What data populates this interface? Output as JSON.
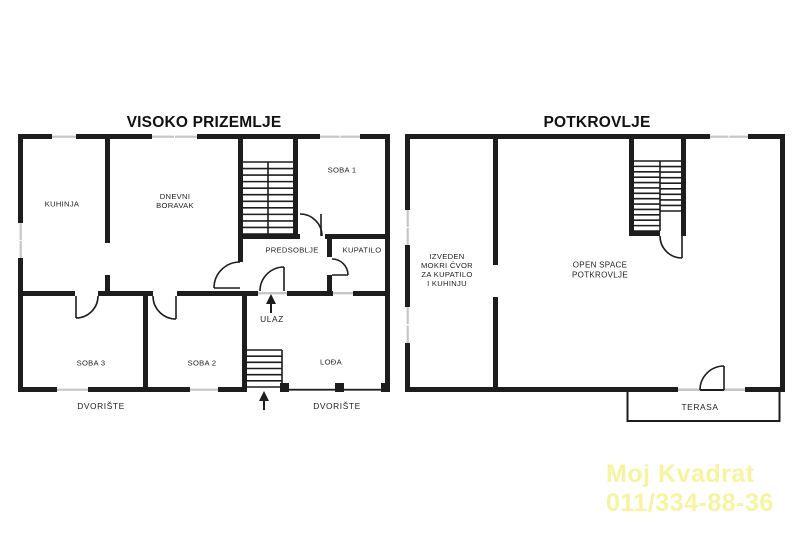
{
  "plans": {
    "ground": {
      "title": "VISOKO PRIZEMLJE",
      "rooms": {
        "kuhinja": "KUHINJA",
        "dnevni_1": "DNEVNI",
        "dnevni_2": "BORAVAK",
        "soba1": "SOBA 1",
        "predsoblje": "PREDSOBLJE",
        "kupatilo": "KUPATILO",
        "soba3": "SOBA 3",
        "soba2": "SOBA 2",
        "lodja": "LOĐA",
        "ulaz": "ULAZ",
        "dvoriste_left": "DVORIŠTE",
        "dvoriste_right": "DVORIŠTE"
      }
    },
    "attic": {
      "title": "POTKROVLJE",
      "rooms": {
        "mokri_1": "IZVEDEN",
        "mokri_2": "MOKRI ČVOR",
        "mokri_3": "ZA KUPATILO",
        "mokri_4": "I KUHINJU",
        "open_1": "OPEN SPACE",
        "open_2": "POTKROVLJE",
        "terasa": "TERASA"
      }
    }
  },
  "watermark": {
    "line1": "Moj Kvadrat",
    "line2": "011/334-88-36",
    "color": "#f8f3a0"
  },
  "colors": {
    "wall": "#1d1d1d",
    "window_glass": "#c6c6c6"
  }
}
